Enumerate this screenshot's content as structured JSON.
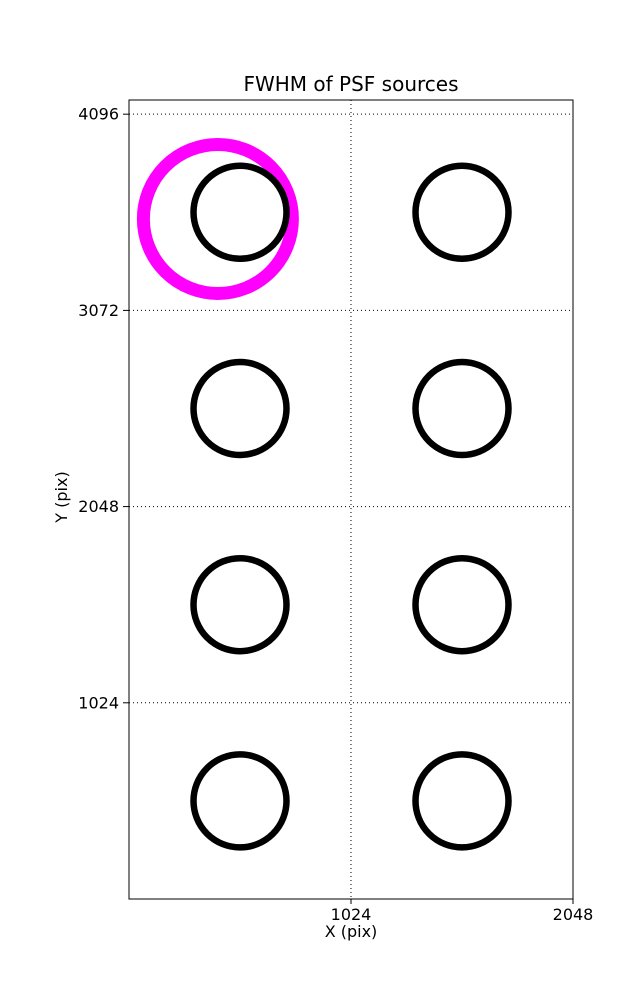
{
  "figure": {
    "title": "FWHM of PSF sources",
    "xlabel": "X (pix)",
    "ylabel": "Y (pix)",
    "background_color": "#ffffff",
    "axis_color": "#000000"
  },
  "chart_data": {
    "type": "scatter",
    "title": "FWHM of PSF sources",
    "xlabel": "X (pix)",
    "ylabel": "Y (pix)",
    "xlim": [
      0,
      2048
    ],
    "ylim": [
      0,
      4170
    ],
    "xticks": [
      1024,
      2048
    ],
    "yticks": [
      1024,
      2048,
      3072,
      4096
    ],
    "grid": {
      "enabled": true,
      "style": "dotted",
      "color": "#000000"
    },
    "series": [
      {
        "name": "selected-source-highlight",
        "marker": "circle-outline",
        "color": "#ff00ff",
        "stroke_px": 13,
        "radius_px": 74.5,
        "points": [
          {
            "x": 410,
            "y": 3549
          }
        ]
      },
      {
        "name": "psf-source",
        "marker": "circle-outline",
        "color": "#000000",
        "stroke_px": 6.5,
        "radius_px": 46.5,
        "points": [
          {
            "x": 512,
            "y": 3584
          },
          {
            "x": 1536,
            "y": 3584
          },
          {
            "x": 512,
            "y": 2560
          },
          {
            "x": 1536,
            "y": 2560
          },
          {
            "x": 512,
            "y": 1536
          },
          {
            "x": 1536,
            "y": 1536
          },
          {
            "x": 512,
            "y": 512
          },
          {
            "x": 1536,
            "y": 512
          }
        ]
      }
    ]
  }
}
